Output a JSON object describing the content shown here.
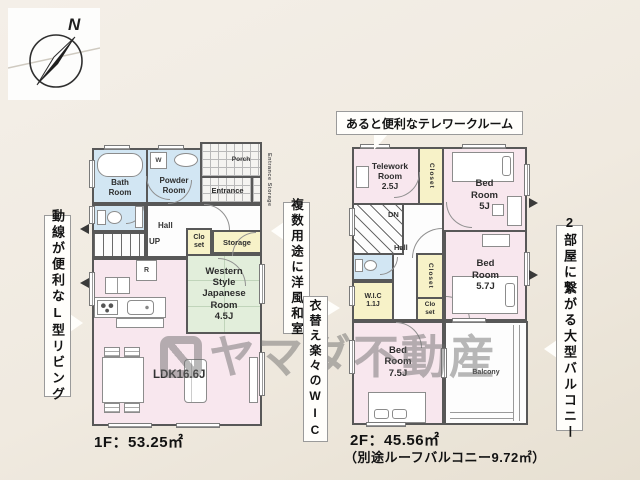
{
  "compass": {
    "north": "N"
  },
  "watermark": {
    "brand": "ヤマダ不動産"
  },
  "callouts": {
    "telework": "あると便利なテレワークルーム",
    "living": "動線が便利なL型リビング",
    "washitsu": "複数用途に洋風和室",
    "wic": "衣替え楽々のWIC",
    "balcony": "2部屋に繋がる大型バルコニー"
  },
  "floor1": {
    "bath_room": "Bath\nRoom",
    "powder_room": "Powder\nRoom",
    "washer": "W",
    "porch": "Porch",
    "entrance": "Entrance",
    "entrance_storage": "Entrance Storage",
    "hall": "Hall",
    "stairs": "UP",
    "closet": "Clo\nset",
    "storage": "Storage",
    "japanese_room": "Western\nStyle\nJapanese\nRoom\n4.5J",
    "fridge": "R",
    "ldk": "LDK16.6J",
    "area": "1F：53.25㎡"
  },
  "floor2": {
    "telework_room": "Telework\nRoom\n2.5J",
    "closet_top": "Closet",
    "bed_room_5j": "Bed\nRoom\n5J",
    "stairs": "DN",
    "hall": "Hall",
    "wic": "W.I.C\n1.1J",
    "closet_mid": "Closet",
    "closet_small": "Clo\nset",
    "bed_room_57j": "Bed\nRoom\n5.7J",
    "bed_room_75j": "Bed\nRoom\n7.5J",
    "balcony": "Balcony",
    "area": "2F：45.56㎡",
    "area_note": "（別途ルーフバルコニー9.72㎡）"
  },
  "colors": {
    "background": "#f0eae0",
    "wall": "#585858",
    "room_pink": "#f8e7ee",
    "room_blue": "#d2e6f3",
    "room_yellow": "#f7f2c8",
    "room_green": "#e2eedb",
    "watermark": "#6a6a6a"
  }
}
